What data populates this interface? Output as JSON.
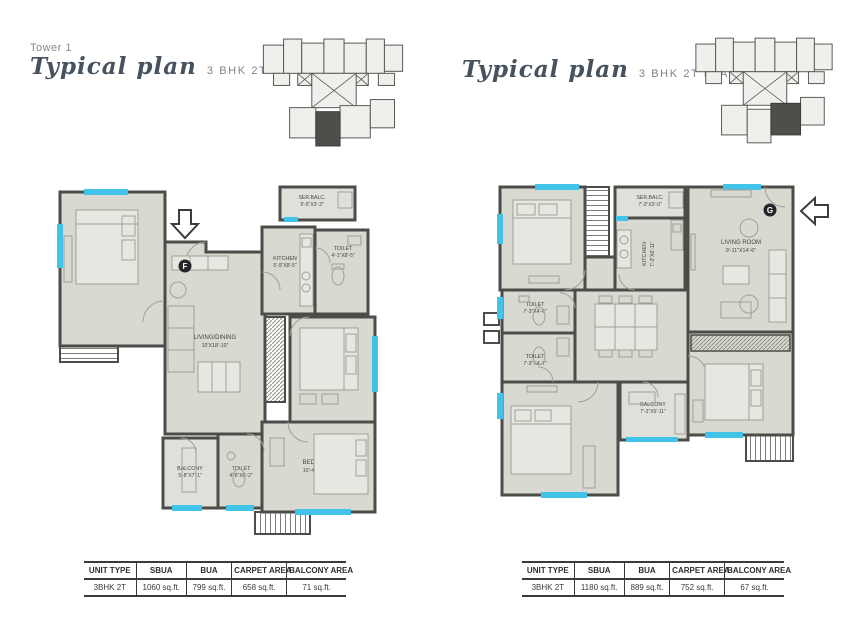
{
  "plans": [
    {
      "tower": "Tower 1",
      "title_script": "Typical plan",
      "subtitle": "3 BHK 2T FLAT F",
      "marker": "F",
      "rooms": {
        "bedroom_tl": {
          "name": "BEDROOM",
          "dims": "9'-11\"X10'-4\""
        },
        "ser_balc": {
          "name": "SER.BALC.",
          "dims": "9'-5\"X3'-3\""
        },
        "kitchen": {
          "name": "KITCHEN",
          "dims": "5'-9\"X8'-5\""
        },
        "toilet_top": {
          "name": "TOILET",
          "dims": "4'-1\"X8'-5\""
        },
        "living_dining": {
          "name": "LIVING/DINING",
          "dims": "10'X18'-10\""
        },
        "bedroom_mid": {
          "name": "BEDROOM",
          "dims": "10'-2\"X10'-10\""
        },
        "balcony": {
          "name": "BALCONY",
          "dims": "5'-8\"X7'-1\""
        },
        "toilet_bottom": {
          "name": "TOILET",
          "dims": "4'-6\"X6'-2\""
        },
        "bedroom_bottom": {
          "name": "BEDROOM",
          "dims": "10'-4\"X10'-4\""
        }
      },
      "table": {
        "headers": [
          "UNIT TYPE",
          "SBUA",
          "BUA",
          "CARPET AREA",
          "BALCONY AREA"
        ],
        "values": [
          "3BHK 2T",
          "1060 sq.ft.",
          "799 sq.ft.",
          "658 sq.ft.",
          "71 sq.ft."
        ]
      }
    },
    {
      "title_script": "Typical plan",
      "subtitle": "3 BHK 2T FLAT G",
      "marker": "G",
      "rooms": {
        "bedroom_tl": {
          "name": "BEDROOM",
          "dims": "11'-1\"X10'"
        },
        "ser_balc": {
          "name": "SER.BALC.",
          "dims": "7'-3\"X3'-0\""
        },
        "kitchen": {
          "name": "KITCHEN",
          "dims": "7'-3\"X6'-11\""
        },
        "living_room": {
          "name": "LIVING ROOM",
          "dims": "9'-11\"X14'-6\""
        },
        "toilet_1": {
          "name": "TOILET",
          "dims": "7'-3\"X4'-6\""
        },
        "toilet_2": {
          "name": "TOILET",
          "dims": "7'-3\"X4'-7\""
        },
        "dining": {
          "name": "DINING",
          "dims": "11'-3\"X9'-5\""
        },
        "bedroom_bl": {
          "name": "BEDROOM",
          "dims": "11'-1\"X11'-4\""
        },
        "balcony": {
          "name": "BALCONY",
          "dims": "7'-3\"X5'-11\""
        },
        "bedroom_br": {
          "name": "BEDROOM",
          "dims": "10'X10'-7\""
        }
      },
      "table": {
        "headers": [
          "UNIT TYPE",
          "SBUA",
          "BUA",
          "CARPET AREA",
          "BALCONY AREA"
        ],
        "values": [
          "3BHK 2T",
          "1180 sq.ft.",
          "889 sq.ft.",
          "752 sq.ft.",
          "67 sq.ft."
        ]
      }
    }
  ]
}
